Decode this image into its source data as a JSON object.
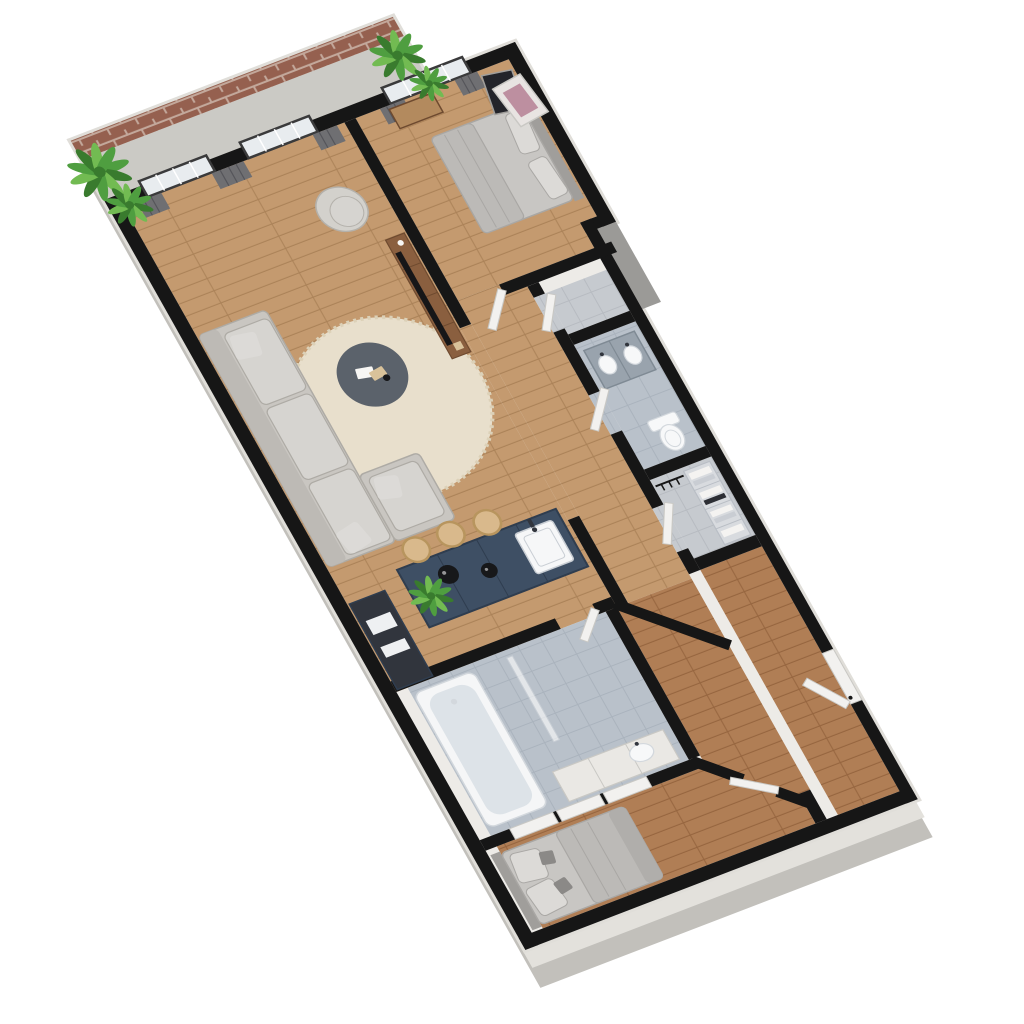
{
  "scene": {
    "type": "3d_floor_plan_render",
    "view": "axonometric top-down, plan rotated so long axis runs from top corner to bottom-right",
    "background": "#ffffff",
    "unit_summary": {
      "bedrooms": 2,
      "bathrooms": 2,
      "rooms": [
        "terrace",
        "living-room",
        "kitchen",
        "bedroom-1",
        "hallway",
        "closet",
        "bathroom-1",
        "laundry-closet",
        "bathroom-2",
        "bedroom-2",
        "entry"
      ]
    },
    "inventory": {
      "terrace": [
        "brick parapet wall",
        "concrete deck",
        "green plant left",
        "green plant right"
      ],
      "living_room": [
        "sectional sofa with chaise",
        "round cream rug",
        "round dark coffee table with books",
        "tub armchair",
        "walnut tv console",
        "tv",
        "grey curtains",
        "two french windows"
      ],
      "kitchen": [
        "navy island with cabinets",
        "white sink with faucet",
        "three wood bar stools",
        "two black sphere pendant lights",
        "tall oven cabinet",
        "small plant"
      ],
      "bedroom_1": [
        "double bed grey linen",
        "headboard",
        "two pillows",
        "wood bench",
        "two leaning art frames",
        "grey curtains",
        "french window",
        "open door leaf"
      ],
      "closet": [
        "empty closet room",
        "open door leaf"
      ],
      "bathroom_1": [
        "grey double vanity with two sinks",
        "toilet",
        "open door leaf"
      ],
      "laundry_closet": [
        "shelving with folded linen",
        "hanging rod",
        "open door leaf"
      ],
      "bathroom_2": [
        "bathtub",
        "glass shower screen",
        "vanity counter with sink",
        "open door leaf"
      ],
      "bedroom_2": [
        "double bed grey linen",
        "pillows with dark accent cushions",
        "three sliding closet panels",
        "open door leaf"
      ],
      "entry": [
        "entrance door on exterior wall",
        "open door leaf"
      ],
      "hallway": [
        "angled chevron walls",
        "wood floor"
      ]
    }
  },
  "palette": {
    "background": "#ffffff",
    "wall": "#161616",
    "ext_face_light": "#edebe7",
    "ext_edge": "#e0ded9",
    "ext_mid": "#e3e1dc",
    "ext_deep": "#c2c0bb",
    "step_face": "#9b9a97",
    "brick": "#95604f",
    "brick_mortar": "#c3a89b",
    "concrete": "#cbcac5",
    "wood": "#c49a6f",
    "wood_line": "#ab8258",
    "wood_dark": "#b07e55",
    "wood_dark_line": "#96653f",
    "tile": "#b9c1ca",
    "tile_line": "#aab3bd",
    "tile_light": "#c6cacf",
    "tile_light_line": "#b7bbc1",
    "rug": "#e8dfcc",
    "rug_edge": "#dcd1b8",
    "sofa": "#c9c6c1",
    "sofa_back": "#bdbab5",
    "sofa_line": "#aeaba5",
    "cushion": "#d6d4d0",
    "pillow": "#dcdad7",
    "pillow_dark": "#8b8987",
    "coffee_table": "#5b626b",
    "deco_white": "#f7f6f4",
    "deco_tan": "#d9c29a",
    "armchair": "#d3d1cc",
    "armchair_line": "#b4b1ab",
    "tv_console": "#8a5f3f",
    "tv_console_line": "#6e4a2f",
    "tv": "#161618",
    "island": "#3e4f64",
    "island_line": "#2f3d4f",
    "sink": "#f6f7f8",
    "sink_line": "#c9ced4",
    "stool": "#d9b98c",
    "stool_line": "#b8955e",
    "pendant": "#17181a",
    "oven": "#31353d",
    "oven_white": "#eef0f2",
    "curtain": "#6f6f72",
    "curtain_line": "#55555a",
    "frame": "#3a3a3b",
    "glass": "#e8ecef",
    "mullion": "#ffffff",
    "bed": "#c8c6c3",
    "bed_line": "#a9a7a4",
    "duvet": "#bcbab7",
    "throw": "#b0aeab",
    "headboard": "#a09e9b",
    "bench": "#b38a5e",
    "art_dark": "#23242a",
    "art_white": "#e8e4e2",
    "art_accent": "#bd8fa0",
    "door": "#f2f1ef",
    "door_line": "#c9c8c4",
    "tub": "#f5f6f7",
    "tub_inner": "#dde3e8",
    "vanity": "#99a3ad",
    "vanity_line": "#7f8a94",
    "fixture_white": "#f7f8f9",
    "fixture_line": "#d3d8dd",
    "bath_counter": "#eae8e4",
    "shelf": "#d8dbdf",
    "shelf_line": "#b9bec5",
    "cloth_white": "#f4f3f1",
    "cloth_grey": "#c9cdd3",
    "cloth_dark": "#2c2e34",
    "plant": "#4f9e40",
    "plant_dark": "#397b2e",
    "plant_light": "#72bb52"
  }
}
